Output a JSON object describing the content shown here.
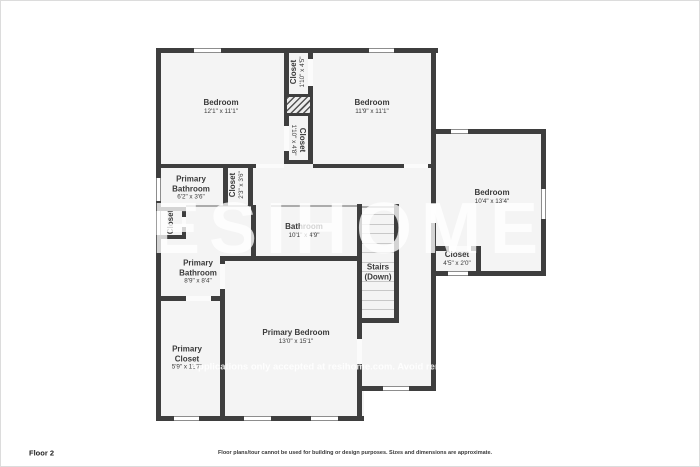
{
  "floor_label": "Floor 2",
  "disclaimer": "Floor plans/tour cannot be used for building or design purposes. Sizes and dimensions are approximate.",
  "watermark": {
    "brand": "RESIHOME",
    "notice": "Applications only accepted at resihome.com. Avoid rental fraud."
  },
  "colors": {
    "wall": "#3e3e3e",
    "floor": "#f4f4f4",
    "window_frame": "#8d8d8d",
    "label_text": "#3a3a3a",
    "watermark": "#ffffff"
  },
  "rooms": [
    {
      "id": "bedroom-1",
      "name": "Bedroom",
      "dims": "12'1\" x 11'1\""
    },
    {
      "id": "bedroom-2",
      "name": "Bedroom",
      "dims": "11'9\" x 11'1\""
    },
    {
      "id": "bedroom-3",
      "name": "Bedroom",
      "dims": "10'4\" x 13'4\""
    },
    {
      "id": "closet-top",
      "name": "Closet",
      "dims": "1'10\" x 4'5\""
    },
    {
      "id": "closet-mid",
      "name": "Closet",
      "dims": "1'10\" x 4'8\""
    },
    {
      "id": "primary-bathroom-small",
      "name": "Primary Bathroom",
      "dims": "6'2\" x 3'6\""
    },
    {
      "id": "closet-hall",
      "name": "Closet",
      "dims": "2'3\" x 3'6\""
    },
    {
      "id": "closet-left",
      "name": "Closet",
      "dims": ""
    },
    {
      "id": "primary-bathroom",
      "name": "Primary Bathroom",
      "dims": "8'9\" x 8'4\""
    },
    {
      "id": "bathroom",
      "name": "Bathroom",
      "dims": "10'1\" x 4'9\""
    },
    {
      "id": "stairs",
      "name": "Stairs (Down)",
      "dims": ""
    },
    {
      "id": "closet-wing",
      "name": "Closet",
      "dims": "4'5\" x 2'0\""
    },
    {
      "id": "primary-closet",
      "name": "Primary Closet",
      "dims": "5'9\" x 11'7\""
    },
    {
      "id": "primary-bedroom",
      "name": "Primary Bedroom",
      "dims": "13'0\" x 15'1\""
    }
  ]
}
